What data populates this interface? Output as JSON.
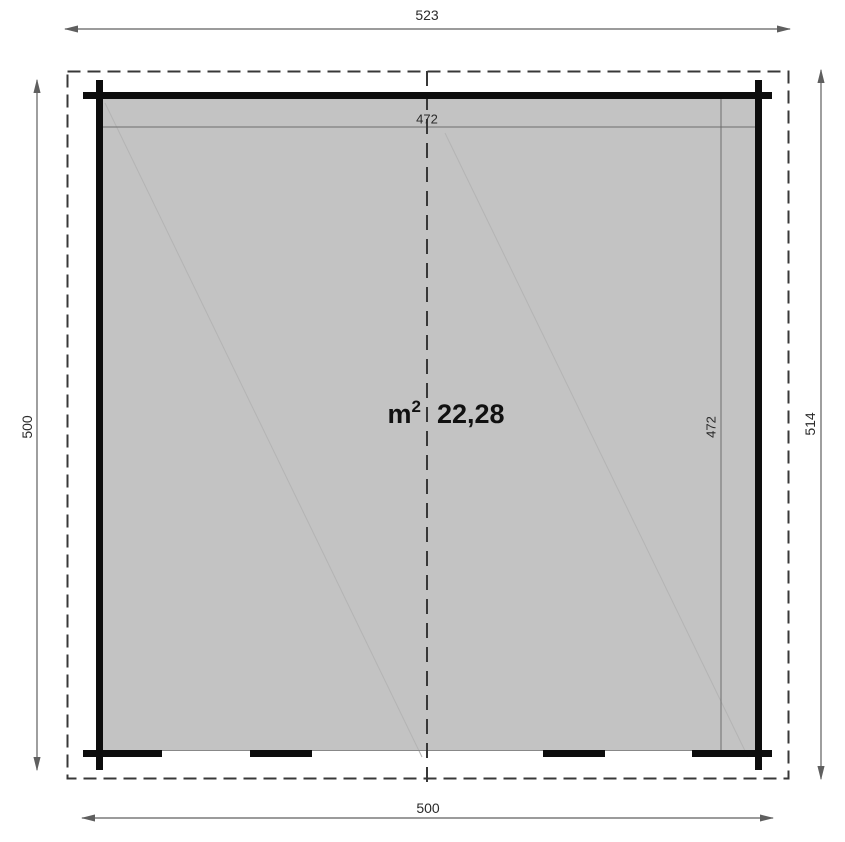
{
  "plan": {
    "dimensions": {
      "overall_width_top": "523",
      "interior_width": "472",
      "left_height": "500",
      "right_height": "514",
      "interior_height": "472",
      "overall_width_bottom": "500"
    },
    "area": {
      "unit_base": "m",
      "unit_exponent": "2",
      "value": "22,28"
    },
    "colors": {
      "wall": "#0d0d0d",
      "floor_fill": "#c3c3c3",
      "dashed_outline": "#383838",
      "dimension_line": "#5f5f5f",
      "faint_line": "#b4b4b4"
    }
  }
}
